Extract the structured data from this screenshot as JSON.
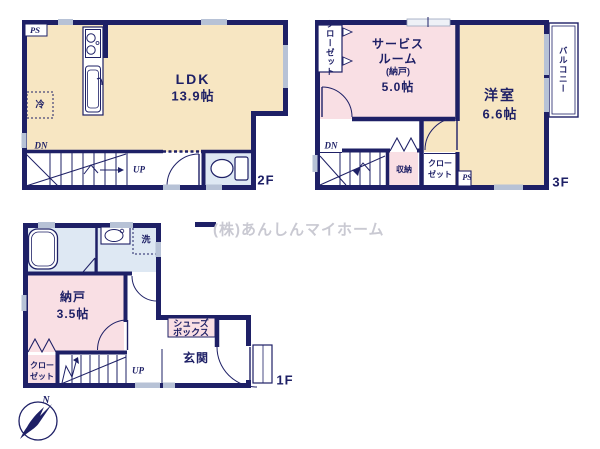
{
  "watermark": {
    "company": "(株)あんしんマイホーム"
  },
  "colors": {
    "wall": "#1e2066",
    "room_cream": "#f7e6c2",
    "room_pink": "#f9dfe4",
    "room_blue": "#dee8f3",
    "window_mark": "#b7c2d6",
    "watermark_text": "#c9c9d2"
  },
  "floor2": {
    "label": "2F",
    "ldk_name": "LDK",
    "ldk_size": "13.9帖",
    "ps": "PS",
    "fridge": "冷",
    "dn": "DN",
    "up": "UP"
  },
  "floor3": {
    "label": "3F",
    "closet_top": "クローゼット",
    "service_line1": "サービス",
    "service_line2": "ルーム",
    "service_line3": "(納戸)",
    "service_size": "5.0帖",
    "western_room_name": "洋室",
    "western_room_size": "6.6帖",
    "balcony": "バルコニー",
    "dn": "DN",
    "storage": "収納",
    "closet_line1": "クロー",
    "closet_line2": "ゼット",
    "ps": "PS"
  },
  "floor1": {
    "label": "1F",
    "wash": "洗",
    "nando_name": "納戸",
    "nando_size": "3.5帖",
    "closet_line1": "クロー",
    "closet_line2": "ゼット",
    "up": "UP",
    "shoes_line1": "シューズ",
    "shoes_line2": "ボックス",
    "genkan": "玄関",
    "north": "N"
  }
}
